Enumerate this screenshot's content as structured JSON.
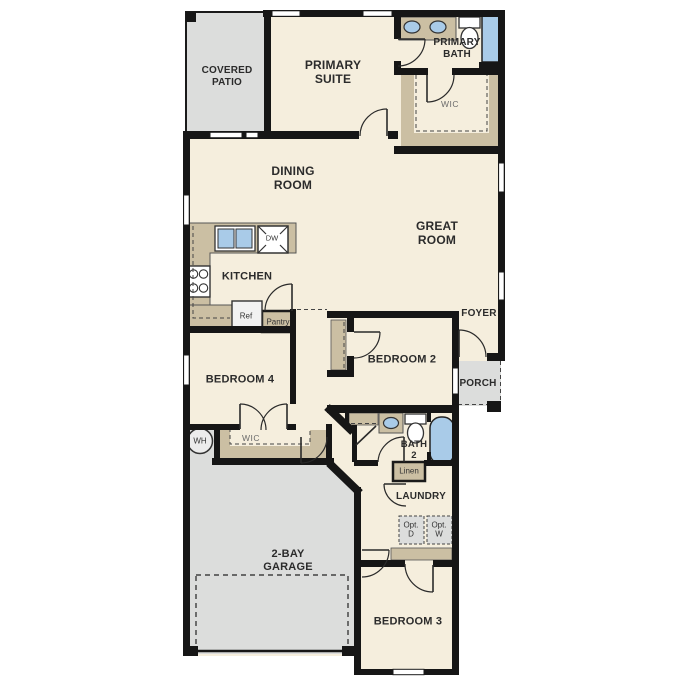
{
  "canvas": {
    "width": 687,
    "height": 687
  },
  "colors": {
    "floor_cream": "#f5eedd",
    "outdoor_gray": "#dcdddc",
    "casework_tan": "#cbbfa3",
    "fixture_blue": "#a9cbe8",
    "wall_black": "#161616"
  },
  "rooms": {
    "covered_patio": {
      "l1": "COVERED",
      "l2": "PATIO"
    },
    "primary_suite": {
      "l1": "PRIMARY",
      "l2": "SUITE"
    },
    "primary_bath": {
      "l1": "PRIMARY",
      "l2": "BATH"
    },
    "primary_wic": {
      "l1": "WIC"
    },
    "dining_room": {
      "l1": "DINING",
      "l2": "ROOM"
    },
    "great_room": {
      "l1": "GREAT",
      "l2": "ROOM"
    },
    "kitchen": {
      "l1": "KITCHEN"
    },
    "foyer": {
      "l1": "FOYER"
    },
    "porch": {
      "l1": "PORCH"
    },
    "bedroom_2": {
      "l1": "BEDROOM 2"
    },
    "bedroom_4": {
      "l1": "BEDROOM 4"
    },
    "bedroom_4_wic": {
      "l1": "WIC"
    },
    "bath_2": {
      "l1": "BATH",
      "l2": "2"
    },
    "laundry": {
      "l1": "LAUNDRY"
    },
    "garage": {
      "l1": "2-BAY",
      "l2": "GARAGE"
    },
    "bedroom_3": {
      "l1": "BEDROOM 3"
    }
  },
  "fixtures": {
    "dishwasher": "DW",
    "refrigerator": "Ref",
    "pantry": "Pantry",
    "linen": "Linen",
    "water_heater": "WH",
    "opt_dryer": {
      "l1": "Opt.",
      "l2": "D"
    },
    "opt_washer": {
      "l1": "Opt.",
      "l2": "W"
    }
  }
}
